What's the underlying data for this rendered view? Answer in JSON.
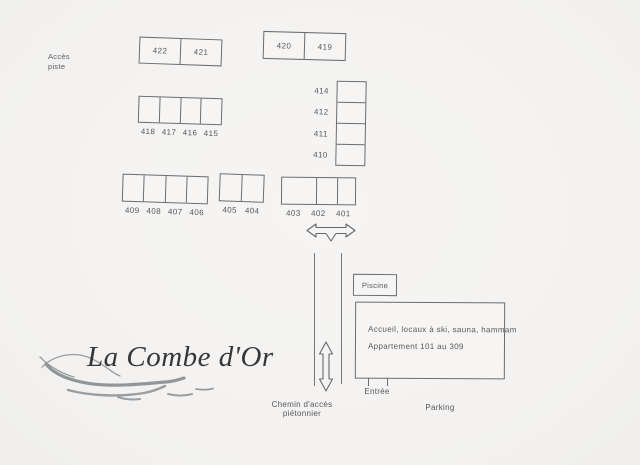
{
  "scene": {
    "logo_text": "La Combe d'Or",
    "acces_piste_line1": "Accès",
    "acces_piste_line2": "piste",
    "chemin_label": "Chemin d'accès piétonnier",
    "parking_label": "Parking",
    "entree_label": "Entrée",
    "piscine_label": "Piscine",
    "building_line1": "Accueil, locaux à ski, sauna, hammam",
    "building_line2": "Appartement 101 au 309"
  },
  "blocks": {
    "b422": {
      "units": [
        "422",
        "421"
      ]
    },
    "b420": {
      "units": [
        "420",
        "419"
      ]
    },
    "b418": {
      "units": [
        "418",
        "417",
        "416",
        "415"
      ]
    },
    "b414": {
      "units": [
        "414",
        "412",
        "411",
        "410"
      ]
    },
    "b409": {
      "units": [
        "409",
        "408",
        "407",
        "406"
      ]
    },
    "b405": {
      "units": [
        "405",
        "404"
      ]
    },
    "b403": {
      "units": [
        "403",
        "402",
        "401"
      ]
    }
  },
  "icons": {
    "horizontal_double_arrow": "two-way horizontal arrow with downward fork",
    "vertical_double_arrow": "two-way vertical arrow",
    "wave_logo_mark": "grey wave swoosh"
  },
  "colors": {
    "background": "#f4f3f1",
    "line": "#6a6e71",
    "text": "#54585c",
    "logo_text": "#34373a",
    "wave": "#8f959a"
  }
}
